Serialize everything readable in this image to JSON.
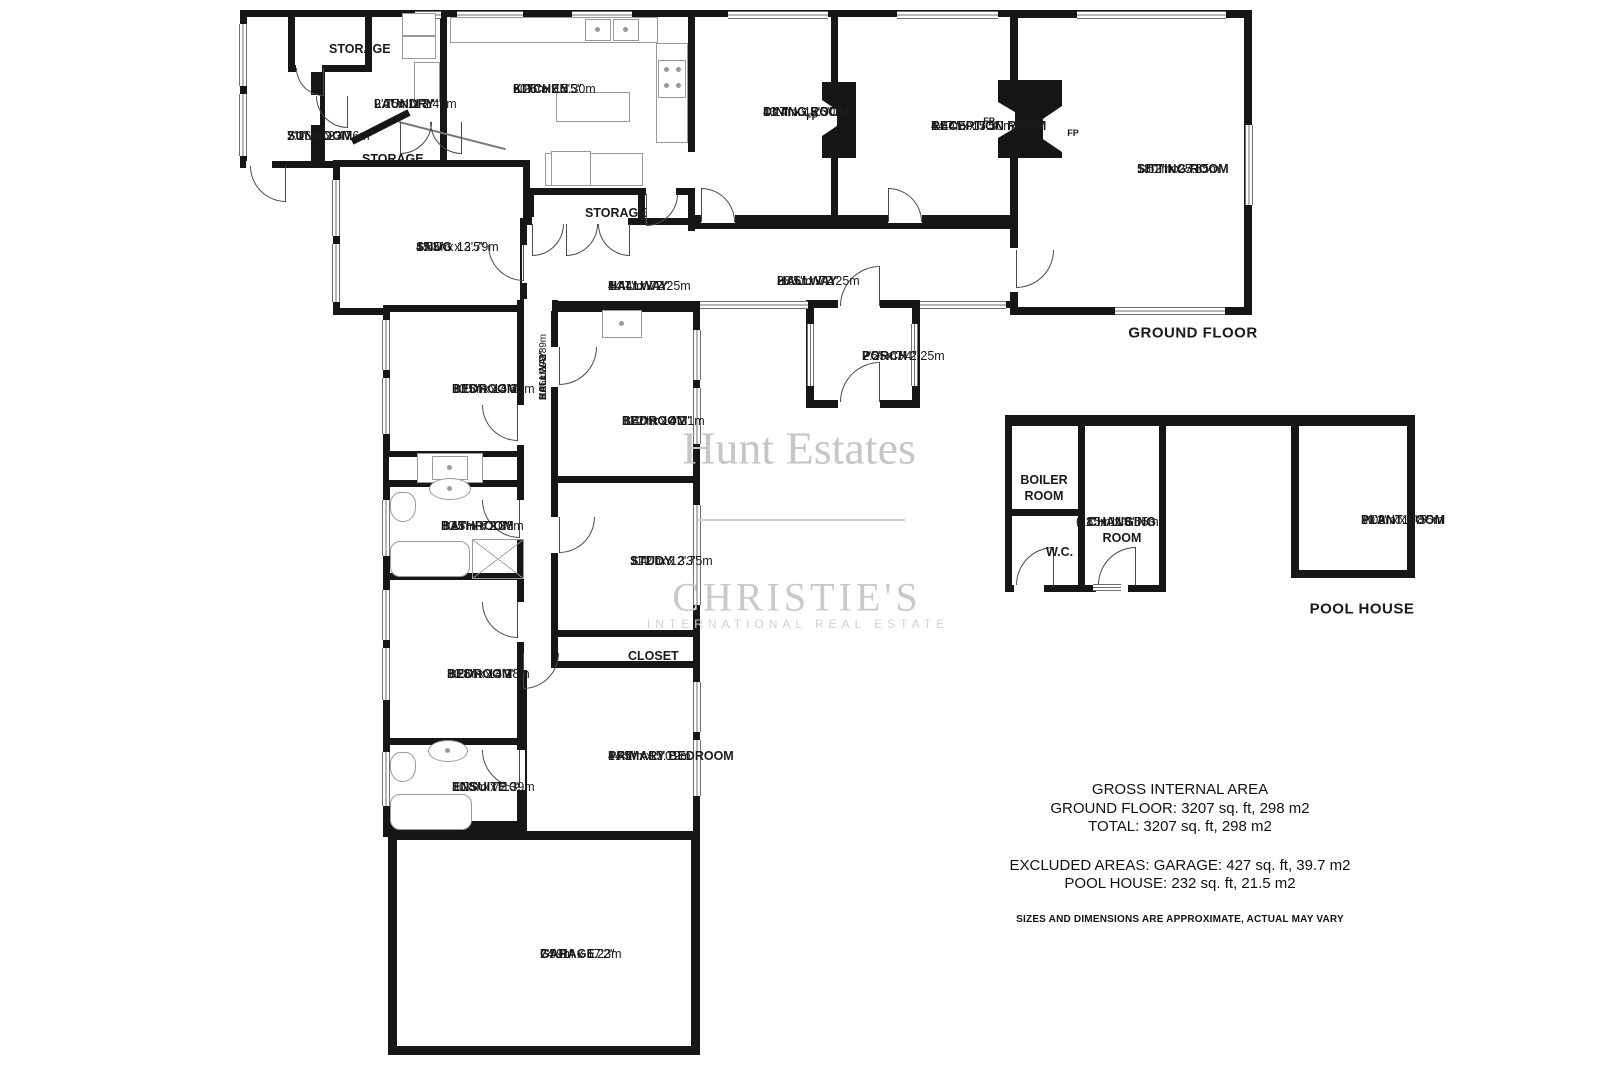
{
  "colors": {
    "wall": "#161616",
    "watermark": "#c8c8c8",
    "window": "#6f6f6f"
  },
  "watermark": {
    "brand": "Hunt Estates",
    "partner": "CHRISTIE'S",
    "partner_sub": "INTERNATIONAL REAL ESTATE"
  },
  "labels": {
    "fp": "FP",
    "ground_floor": "GROUND FLOOR",
    "pool_house": "POOL HOUSE"
  },
  "summary": {
    "line1": "GROSS INTERNAL AREA",
    "line2": "GROUND FLOOR: 3207 sq. ft, 298 m2",
    "line3": "TOTAL: 3207 sq. ft, 298 m2",
    "line4": "EXCLUDED AREAS: GARAGE: 427 sq. ft, 39.7 m2",
    "line5": "POOL HOUSE: 232 sq. ft, 21.5 m2",
    "disclaimer": "SIZES AND DIMENSIONS ARE APPROXIMATE, ACTUAL MAY VARY"
  },
  "rooms": {
    "sunroom": {
      "name": "SUNROOM",
      "ft": "7'1\" x 12'4\"",
      "m": "2.16m x 3.76m"
    },
    "storage_a": {
      "name": "STORAGE"
    },
    "laundry": {
      "name": "LAUNDRY",
      "ft": "9'0\" x 11'2\"",
      "m": "2.75m x 3.41m"
    },
    "storage_b": {
      "name": "STORAGE"
    },
    "kitchen": {
      "name": "KITCHEN",
      "ft": "20'6\" x 17'5\"",
      "m": "6.26m x 5.30m"
    },
    "dining": {
      "name": "DINING ROOM",
      "ft": "13'7\" x 17'5\"",
      "m": "4.14m x 5.30m"
    },
    "reception": {
      "name": "RECEPTION ROOM",
      "ft": "14'7\" x 17'5\"",
      "m": "4.44m x 5.30m"
    },
    "sitting": {
      "name": "SITTING ROOM",
      "ft": "18'1\" x 25'1\"",
      "m": "5.52m x 7.65m"
    },
    "snug": {
      "name": "SNUG",
      "ft": "15'3\" x 12'5\"",
      "m": "4.65m x 3.79m"
    },
    "storage_c": {
      "name": "STORAGE"
    },
    "hallway_front": {
      "name": "HALLWAY",
      "ft": "14'7\" x 7'4\"",
      "m": "4.44m x 2.25m"
    },
    "hallway_main": {
      "name": "HALLWAY",
      "ft": "28'5\" x 7'4\"",
      "m": "8.66m x 2.25m"
    },
    "porch": {
      "name": "PORCH",
      "ft": "7'5\" x 7'4\"",
      "m": "2.25m x 2.25m"
    },
    "bedroom_a": {
      "name": "BEDROOM",
      "ft": "10'5\" x 13'6\"",
      "m": "3.18m x 4.12m"
    },
    "bathroom": {
      "name": "BATHROOM",
      "ft": "10'5\" x 7'10\"",
      "m": "3.18m x 2.38m"
    },
    "bedroom_b": {
      "name": "BEDROOM",
      "ft": "10'8\" x 13'9\"",
      "m": "3.26m x 4.18m"
    },
    "ensuite": {
      "name": "ENSUITE",
      "ft": "10'8\" x 7'10\"",
      "m": "3.25m x 2.39m"
    },
    "hallway_wing": {
      "name": "HALLWAY",
      "ft": "3'6\" x 29'2\"",
      "m": "1.06m x 8.89m"
    },
    "bedroom_c": {
      "name": "BEDROOM",
      "ft": "11'2\" x 14'2\"",
      "m": "3.40m x 4.31m"
    },
    "study": {
      "name": "STUDY",
      "ft": "11'2\" x 12'3\"",
      "m": "3.40m x 3.75m"
    },
    "closet": {
      "name": "CLOSET"
    },
    "primary": {
      "name": "PRIMARY BEDROOM",
      "ft": "14'5\" x 17'0\"",
      "m": "4.41m x 5.19m"
    },
    "garage": {
      "name": "GARAGE",
      "ft": "24'11\" x 17'2\"",
      "m": "7'59m x 5.23m"
    },
    "boiler": {
      "name": "BOILER ROOM"
    },
    "wc": {
      "name": "W.C."
    },
    "changing": {
      "name": "CHANGING ROOM",
      "ft": "6'1\" x 11'8\"",
      "m": "1.85m x 3.55m"
    },
    "plant": {
      "name": "PLANT ROOM",
      "ft": "10'2\" x 11'8\"",
      "m": "3.09m x 3.55m"
    }
  }
}
